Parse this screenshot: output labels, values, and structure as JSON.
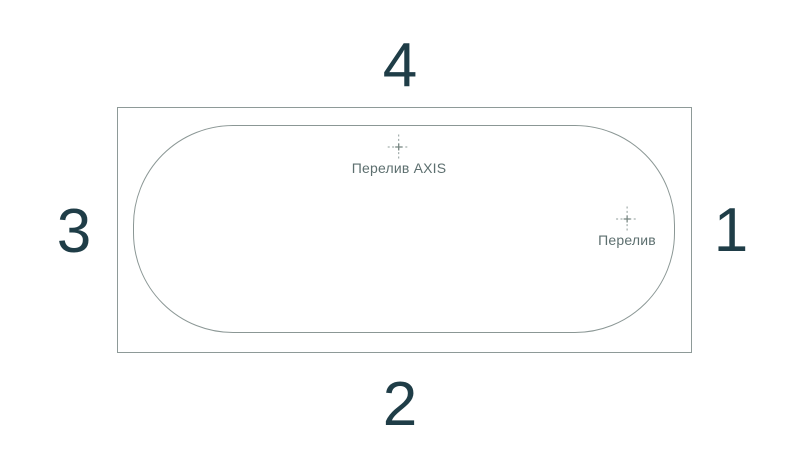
{
  "diagram": {
    "side_numbers": {
      "top": "4",
      "bottom": "2",
      "left": "3",
      "right": "1"
    },
    "markers": {
      "overflow_axis": {
        "label": "Перелив AXIS"
      },
      "overflow": {
        "label": "Перелив"
      }
    },
    "colors": {
      "background": "#ffffff",
      "number_text": "#1f3d47",
      "marker_text": "#5d6f6f",
      "outline_outer": "#8e9a98",
      "outline_inner": "#8b9795",
      "crosshair": "#8f9c9a"
    }
  }
}
